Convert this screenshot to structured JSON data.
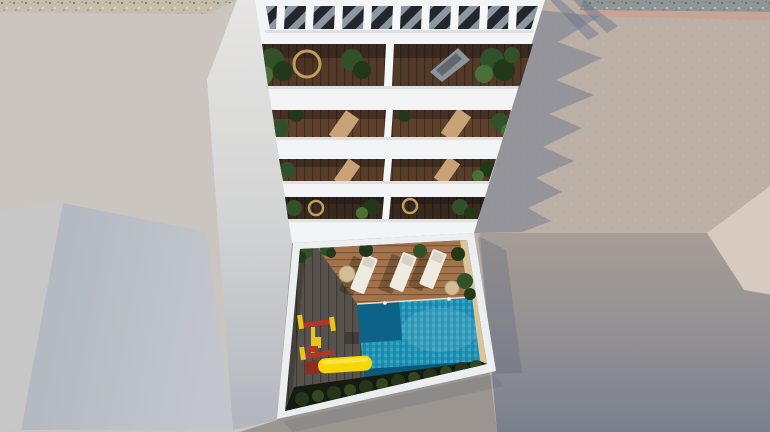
{
  "scene": {
    "description": "Aerial 3D architectural render: white apartment building with rooftop pergola and stacked plant-filled balconies, courtyard below with swimming pool, sun loungers and children's playground, surrounded by grey concrete streets",
    "objects": [
      "rooftop-pergola",
      "balcony-terrace",
      "courtyard",
      "swimming-pool",
      "sun-lounger",
      "playground-swing",
      "playground-slide",
      "hedge",
      "street",
      "gravel-strip"
    ]
  },
  "colors": {
    "left_ground": "#cac5bf",
    "light_sliver": "#c7c7c7",
    "blue_face": "#b4bac3",
    "gravel_left": "#c6bcab",
    "gravel_right": "#8f9595",
    "pink_band": "#c7a496",
    "plaza": "#bcafa5",
    "wedge": "#d6cac1",
    "shadow_blue": "rgba(95,113,138,0.42)",
    "shadow_soft": "rgba(90,100,122,0.30)",
    "shadow_faint": "rgba(90,100,122,0.20)",
    "building_white": "#f2f4f6",
    "wall_white": "#eceff1",
    "slat_white": "#f5f7f9",
    "pergola_dark": "#23272d",
    "deck_t1": "#523928",
    "deck_t2": "#5f412b",
    "deck_t3": "#5a3d29",
    "deck_t4": "#382a1e",
    "deck_grey": "#57524b",
    "deck_warm": "#a3734c",
    "sand": "#d8c59a",
    "pool_light": "#2097ba",
    "pool_dark": "#0d6287",
    "pool_shadow": "#0b5a7c",
    "pool_rim": "#e8e0cc",
    "hedge_dark": "#141c10",
    "hedge_mid": "#263519",
    "hedge_light": "#33461f",
    "plant_dark": "#223818",
    "plant_mid": "#31512a",
    "plant_light": "#4a7038",
    "wicker": "#c09c5e",
    "lounger_white": "#efebe2",
    "lounger_pad": "#d8d2c6",
    "lounger_tan": "#c9a377",
    "lounger_grey": "#8e969b",
    "table_beige": "#d2bd95",
    "play_red": "#b23529",
    "play_red_dark": "#8f2b22",
    "play_yellow": "#e6c51c",
    "slide_yellow": "#f4d703",
    "slide_highlight": "#ffe95c"
  }
}
